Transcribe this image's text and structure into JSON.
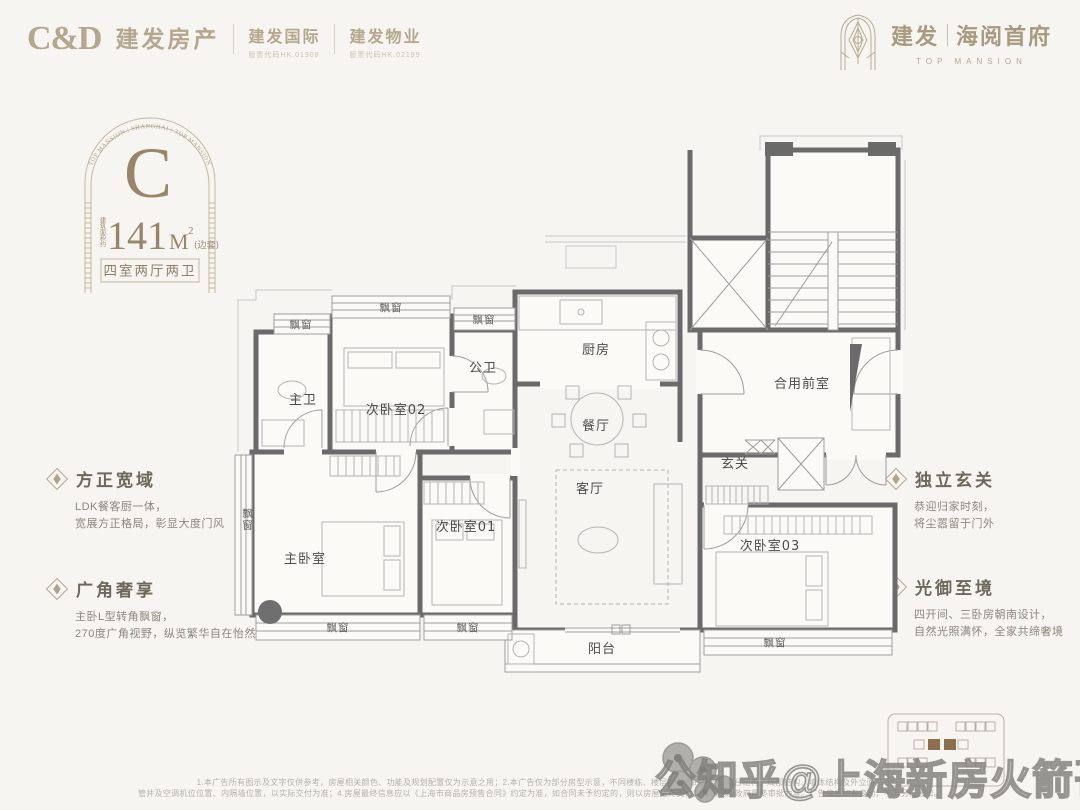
{
  "colors": {
    "background": "#f7f5f1",
    "logo_tan": "#b5a68e",
    "badge_gold": "#998669",
    "wall_gray": "#6a6a6a",
    "keyplan_highlight": "#8d6f50"
  },
  "header": {
    "cnd_logo": "C&D",
    "cnd_brand": "建发房产",
    "intl_name": "建发国际",
    "intl_code": "股票代码HK.01908",
    "prop_name": "建发物业",
    "prop_code": "股票代码HK.02199",
    "project_brand": "建发",
    "project_name": "海阅首府",
    "project_en": "TOP MANSION"
  },
  "badge": {
    "arc_text": "TOP MANSION | SHANGHAI | TOP MANSION",
    "unit_letter": "C",
    "area_prefix": "建筑面积约",
    "area_value": "141",
    "area_unit": "M",
    "area_sup": "2",
    "area_suffix": "(边套)",
    "layout_text": "四室两厅两卫"
  },
  "features": {
    "left": [
      {
        "title": "方正宽域",
        "lines": [
          "LDK餐客厨一体，",
          "宽展方正格局，彰显大度门风"
        ]
      },
      {
        "title": "广角奢享",
        "lines": [
          "主卧L型转角飘窗，",
          "270度广角视野，纵览繁华自在怡然"
        ]
      }
    ],
    "right": [
      {
        "title": "独立玄关",
        "lines": [
          "恭迎归家时刻，",
          "将尘嚣留于门外"
        ]
      },
      {
        "title": "光御至境",
        "lines": [
          "四开间、三卧房朝南设计，",
          "自然光照满怀，全家共缔奢境"
        ]
      }
    ]
  },
  "floorplan": {
    "bay_label": "飘窗",
    "rooms": [
      {
        "id": "master-bath",
        "label": "主卫"
      },
      {
        "id": "bedroom-02",
        "label": "次卧室02"
      },
      {
        "id": "public-bath",
        "label": "公卫"
      },
      {
        "id": "kitchen",
        "label": "厨房"
      },
      {
        "id": "dining-room",
        "label": "餐厅"
      },
      {
        "id": "shared-front-room",
        "label": "合用前室"
      },
      {
        "id": "foyer",
        "label": "玄关"
      },
      {
        "id": "living-room",
        "label": "客厅"
      },
      {
        "id": "master-bedroom",
        "label": "主卧室"
      },
      {
        "id": "bedroom-01",
        "label": "次卧室01"
      },
      {
        "id": "bedroom-03",
        "label": "次卧室03"
      },
      {
        "id": "balcony",
        "label": "阳台"
      }
    ]
  },
  "watermark": "公知乎@上海新房火箭哥",
  "disclaimer": {
    "line1": "1.本广告所有图示及文字仅供参考，房屋相关颜色、功能及规划配置仅为示意之用；2.本广告仅为部分房型示意，不同楼栋、楼层、单元的朝向、阳台结构、局部结构、墙体结构及外立面、",
    "line2": "管井及空调机位位置、内隔墙位置，以实际交付为准；4.房屋最终信息应以《上海市商品房预售合同》约定为准，如合同未予约定的，则以房屋最终交付实际状况及政府最终审批为准。广告信息如有变动，不再另行通知。"
  }
}
